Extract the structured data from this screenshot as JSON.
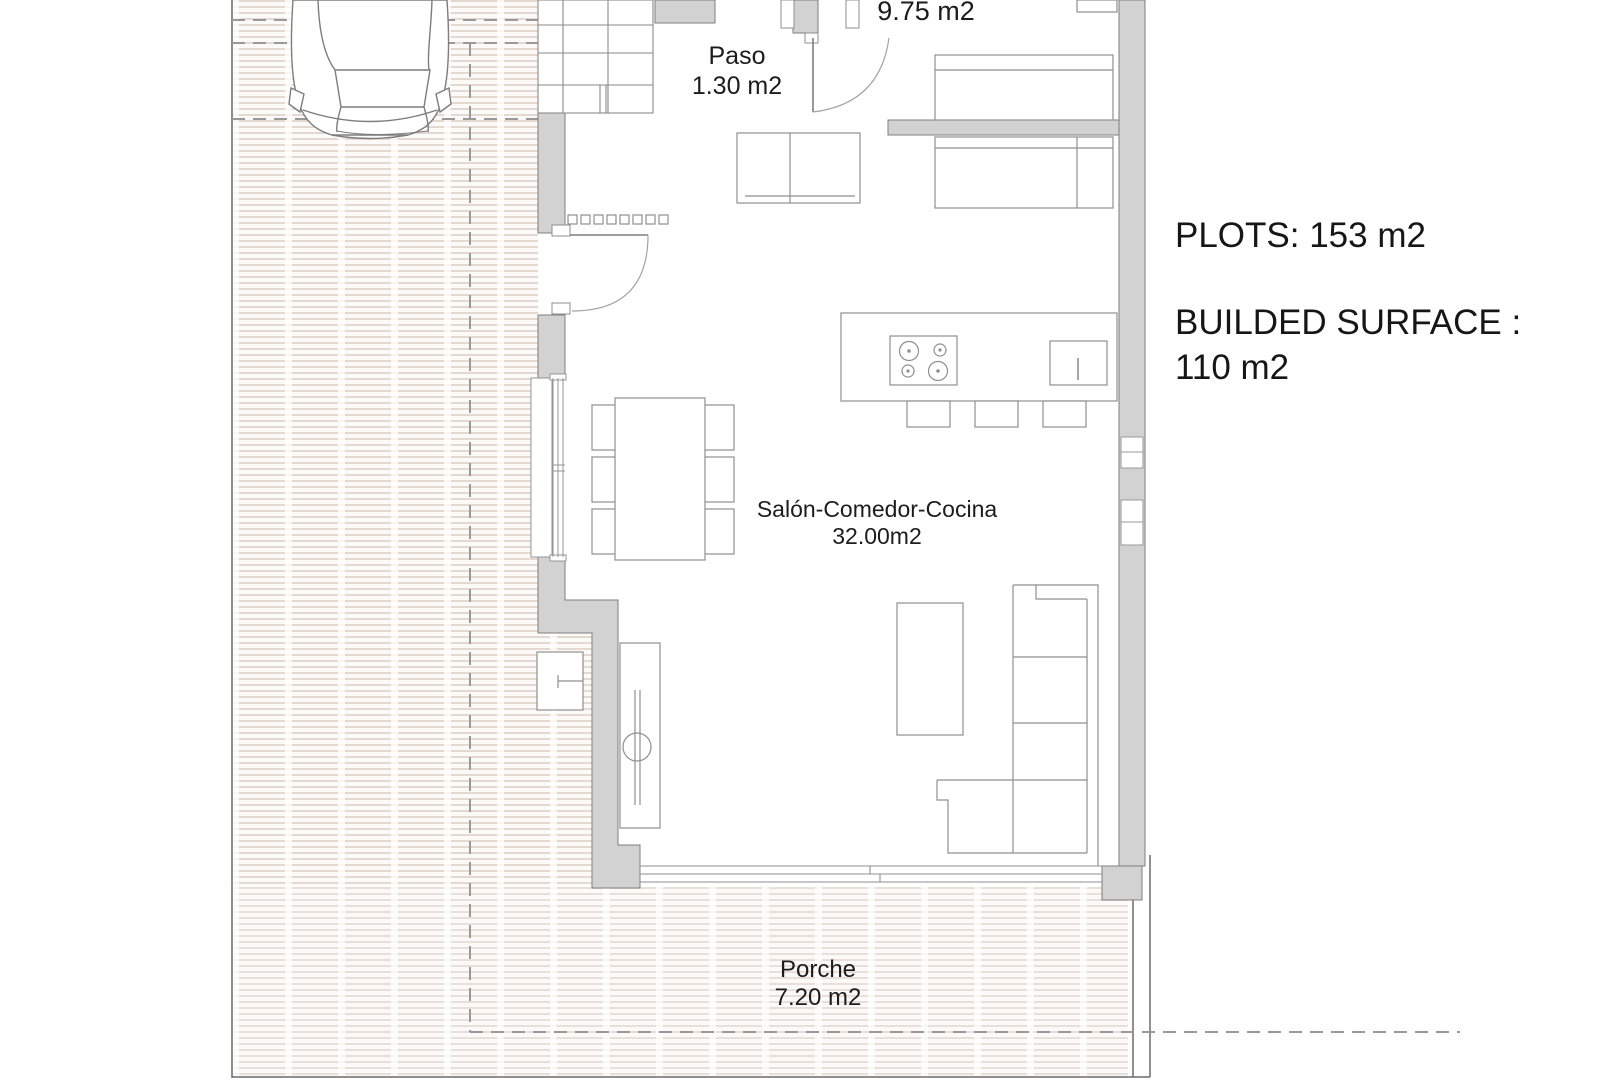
{
  "info_panel": {
    "plots": "PLOTS: 153 m2",
    "builded_surface_label": "BUILDED SURFACE :",
    "builded_surface_value": "110 m2"
  },
  "rooms": {
    "bedroom": {
      "area": "9.75 m2"
    },
    "paso": {
      "name": "Paso",
      "area": "1.30 m2"
    },
    "salon": {
      "name": "Salón-Comedor-Cocina",
      "area": "32.00m2"
    },
    "porche": {
      "name": "Porche",
      "area": "7.20 m2"
    }
  },
  "colors": {
    "wall_fill": "#d2d2d2",
    "wall_stroke": "#7f7f7f",
    "furniture_line": "#8f8f8f",
    "hatch_stripe": "#e3d9cf",
    "dashed_line": "#999999",
    "text": "#1c1c1c"
  }
}
